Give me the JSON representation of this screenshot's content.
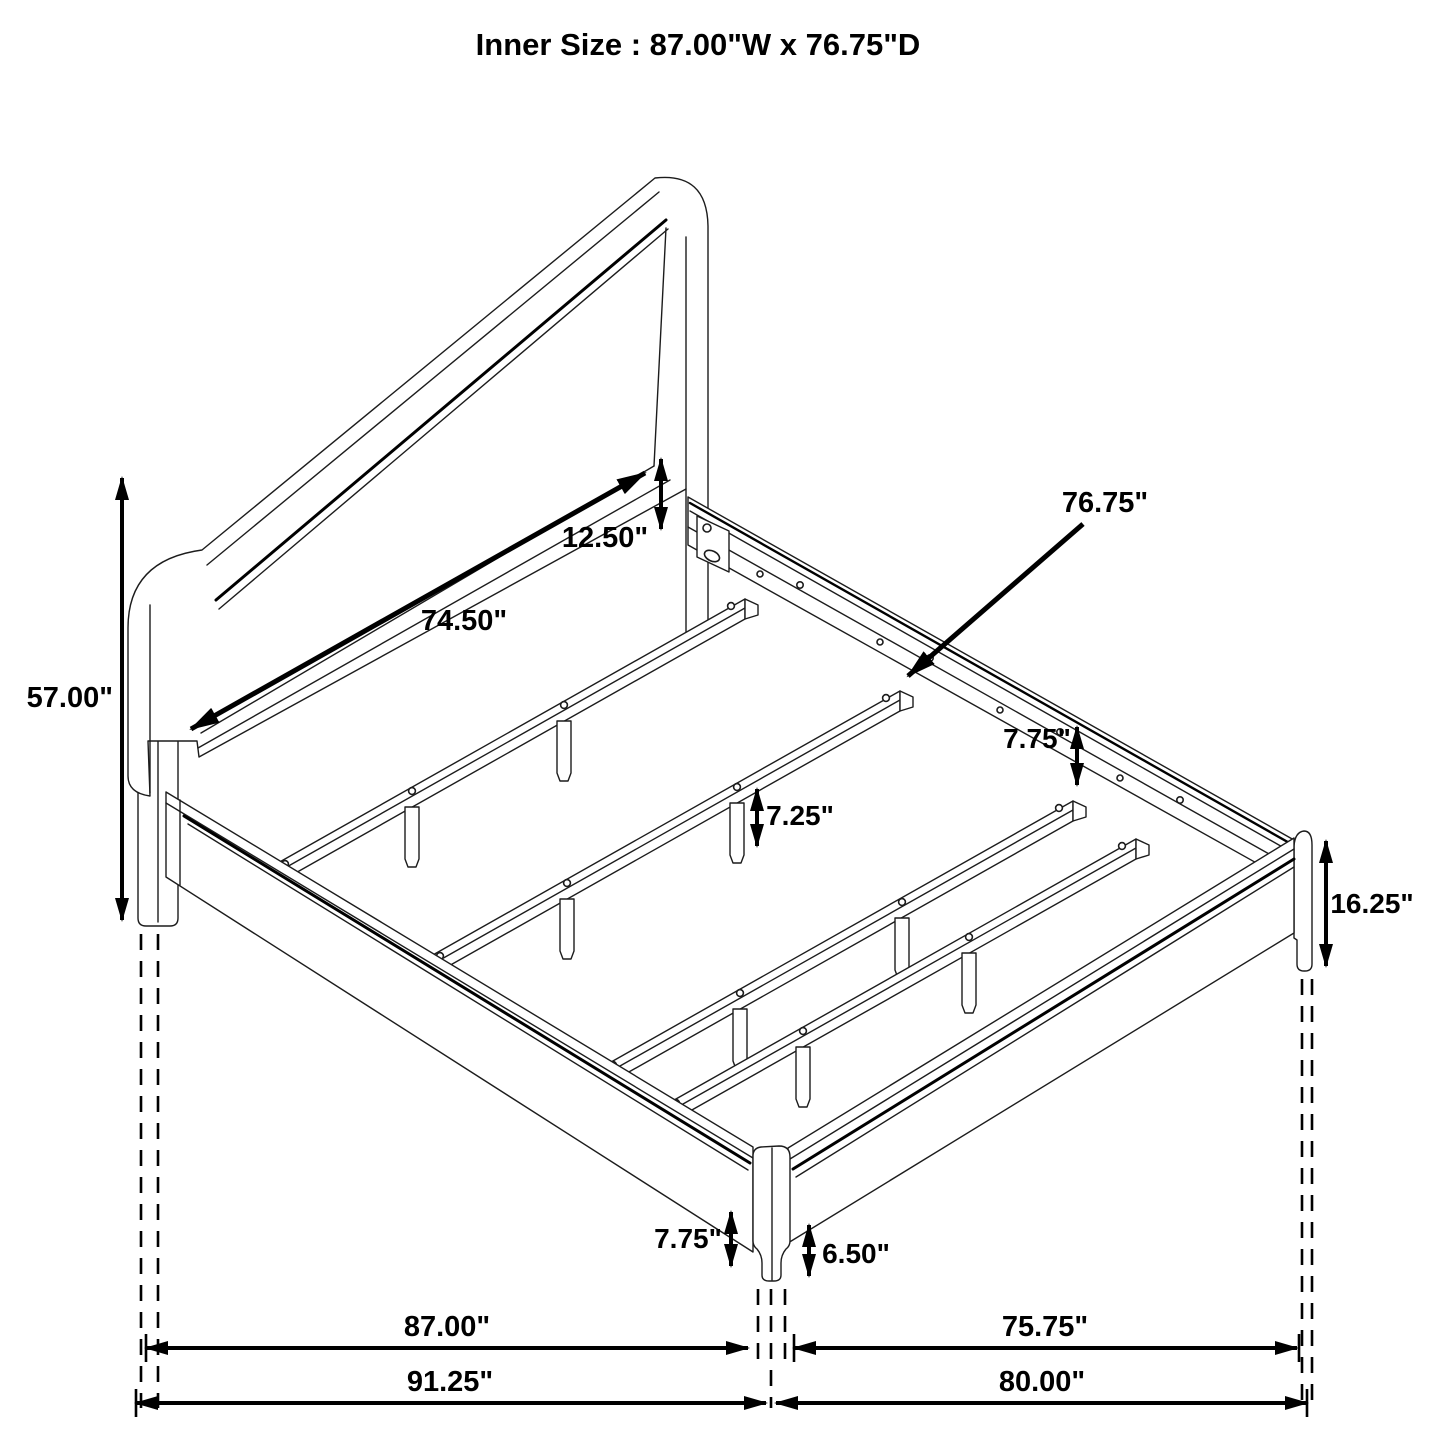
{
  "title": "Inner Size : 87.00\"W x 76.75\"D",
  "dimensions": {
    "headboard_height": "57.00\"",
    "headboard_panel_width": "74.50\"",
    "headboard_panel_offset": "12.50\"",
    "inner_depth": "76.75\"",
    "rail_height_rear": "7.75\"",
    "center_support_height": "7.25\"",
    "footboard_height": "16.25\"",
    "front_leg_height": "7.75\"",
    "front_leg_exposed": "6.50\"",
    "inner_width": "87.00\"",
    "footboard_inner_width": "75.75\"",
    "overall_width": "91.25\"",
    "overall_depth": "80.00\""
  }
}
